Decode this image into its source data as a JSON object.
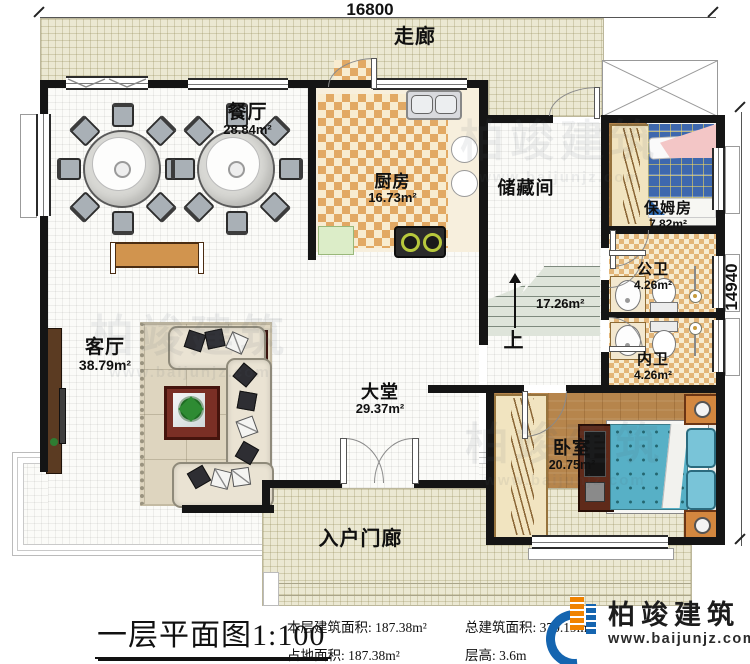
{
  "dimensions": {
    "top": "16800",
    "right": "14940"
  },
  "rooms": {
    "corridor": {
      "name": "走廊"
    },
    "dining": {
      "name": "餐厅",
      "area": "28.84m²"
    },
    "kitchen": {
      "name": "厨房",
      "area": "16.73m²"
    },
    "storage": {
      "name": "储藏间"
    },
    "nanny": {
      "name": "保姆房",
      "area": "7.82m²"
    },
    "public_bath": {
      "name": "公卫",
      "area": "4.26m²"
    },
    "private_bath": {
      "name": "内卫",
      "area": "4.26m²"
    },
    "living": {
      "name": "客厅",
      "area": "38.79m²"
    },
    "hall": {
      "name": "大堂",
      "area": "29.37m²"
    },
    "bedroom": {
      "name": "卧室",
      "area": "20.75m²"
    },
    "porch": {
      "name": "入户门廊"
    },
    "stairs": {
      "area": "17.26m²",
      "up": "上"
    }
  },
  "footer": {
    "title": "一层平面图",
    "scale": "1:100",
    "stats": [
      {
        "label": "本层建筑面积:",
        "value": "187.38m²"
      },
      {
        "label": "总建筑面积:",
        "value": "370.19m²"
      },
      {
        "label": "占地面积:",
        "value": "187.38m²"
      },
      {
        "label": "层高:",
        "value": "3.6m"
      }
    ],
    "brand": {
      "name": "柏竣建筑",
      "website": "www.baijunjz.com"
    }
  },
  "watermark": {
    "name": "柏竣建筑",
    "website": "www.baijunjz.com"
  },
  "colors": {
    "wall": "#151515",
    "corridor": "#ebe8d2",
    "kitchen_checker": "#e2a964",
    "bed_blue": "#57b0c6",
    "brand_blue": "#1565b0",
    "brand_orange": "#f08300"
  }
}
